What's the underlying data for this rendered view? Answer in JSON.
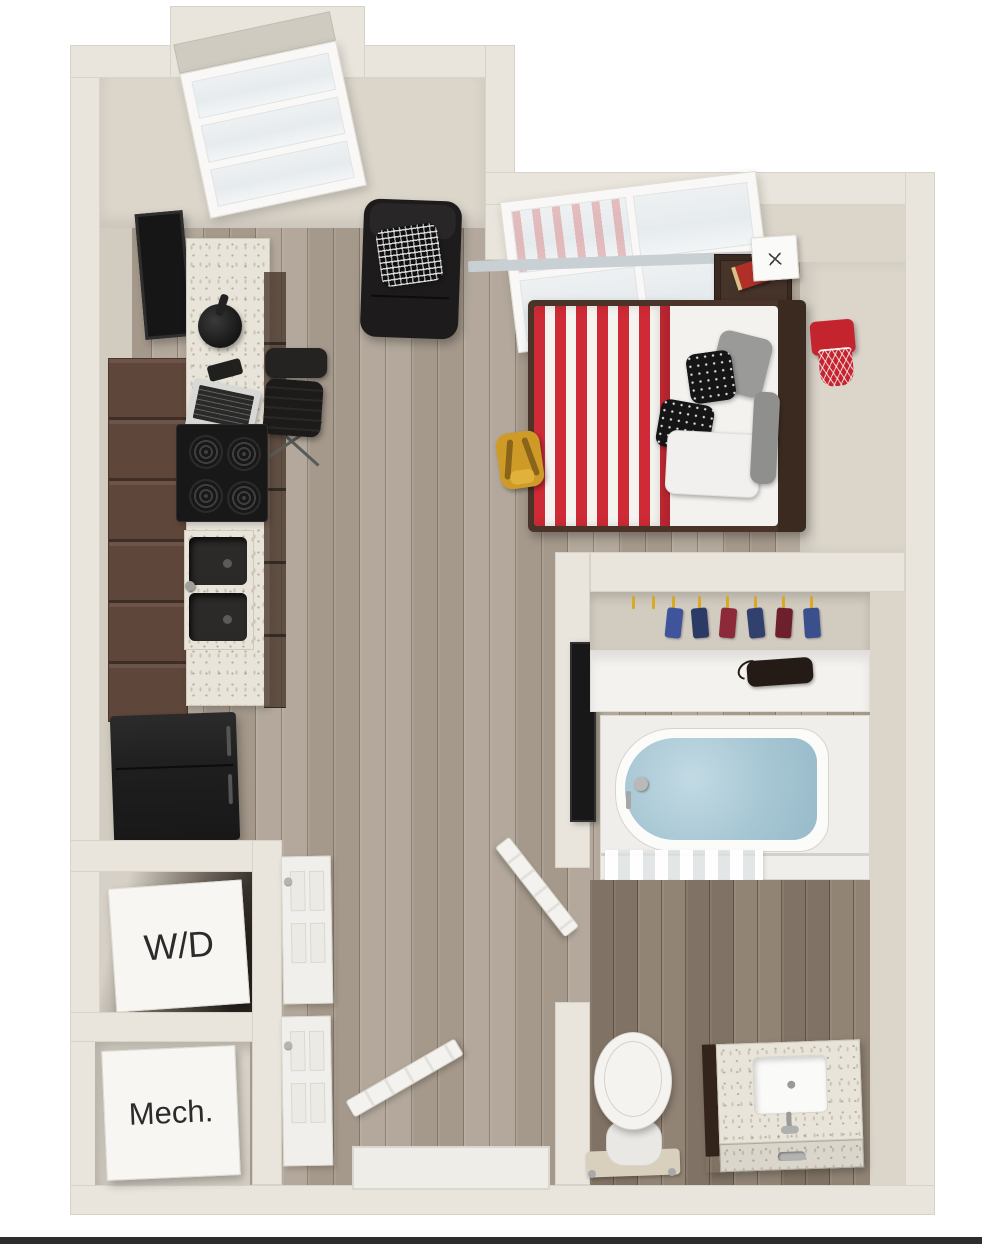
{
  "scene": {
    "title": "3D studio apartment floor plan",
    "labels": {
      "washer_dryer": "W/D",
      "mechanical": "Mech."
    },
    "rooms": [
      "kitchen",
      "living-sleeping-area",
      "closet",
      "bathroom",
      "washer-dryer-closet",
      "mechanical-closet",
      "entry"
    ],
    "furniture": [
      "wall-tv",
      "kitchen-counter",
      "coffee-maker",
      "smartphone",
      "laptop",
      "desk-chair",
      "range-stove",
      "double-sink",
      "refrigerator",
      "upper-cabinets",
      "chaise-lounge",
      "maze-pillow",
      "bed",
      "striped-blanket",
      "nightstand",
      "cube-lamp",
      "red-book",
      "basketball-hoop",
      "yellow-backpack",
      "partition-tv",
      "closet-shelf",
      "hanging-clothes",
      "shelf-bag",
      "bathtub",
      "shower-curtain",
      "toilet",
      "vanity-sink",
      "washer-dryer-unit",
      "mechanical-unit",
      "entry-door",
      "bathroom-door",
      "closet-doors"
    ],
    "colors": {
      "background": "#ffffff",
      "outer_wall": "#e9e5dc",
      "inner_wall_face": "#dbd5ca",
      "floor_wood_main": "#aea395",
      "floor_wood_bath": "#8b7d6e",
      "counter_speckle": "#e8e4d9",
      "cabinet_brown": "#5f463a",
      "appliance_black": "#1a1a1a",
      "accent_red": "#cf2b36",
      "hoop_red": "#c4242e",
      "bath_water_blue": "#a6c6d3",
      "hanger_yellow": "#d8a829",
      "backpack_yellow": "#cf9b28",
      "bottom_bar": "#2d2d2d"
    }
  }
}
